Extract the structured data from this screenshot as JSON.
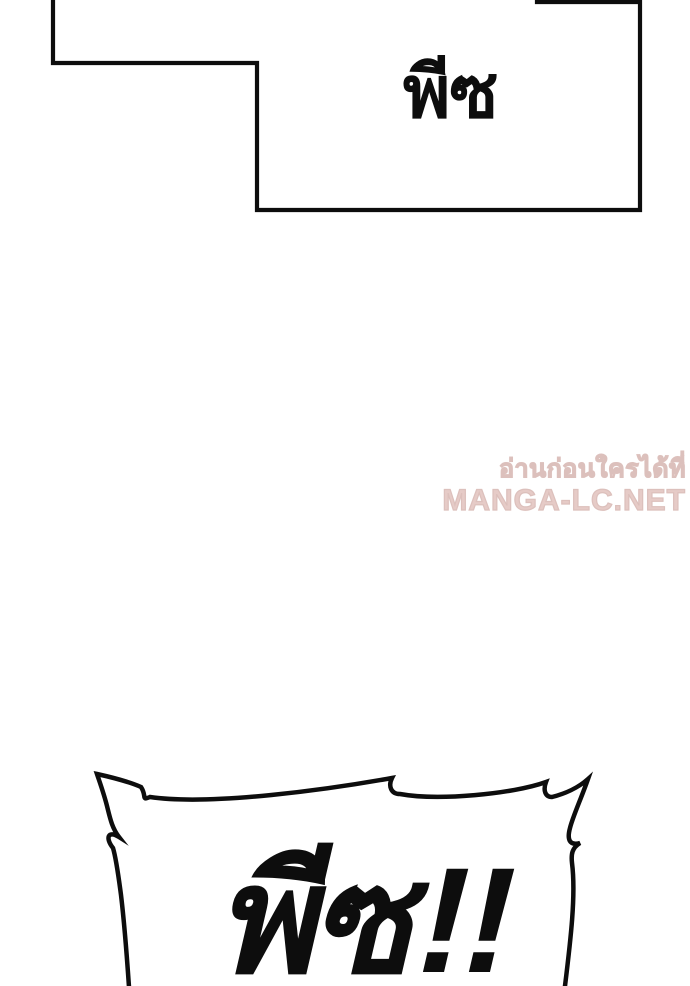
{
  "page": {
    "background_color": "#ffffff",
    "ink_color": "#0d0d0d"
  },
  "top_bubble": {
    "text": "พีซ"
  },
  "burst_bubble": {
    "text": "พีซ!!"
  },
  "watermark": {
    "line1": "อ่านก่อนใครได้ที่",
    "line2": "MANGA-LC.NET",
    "color": "#e6cbc7"
  }
}
